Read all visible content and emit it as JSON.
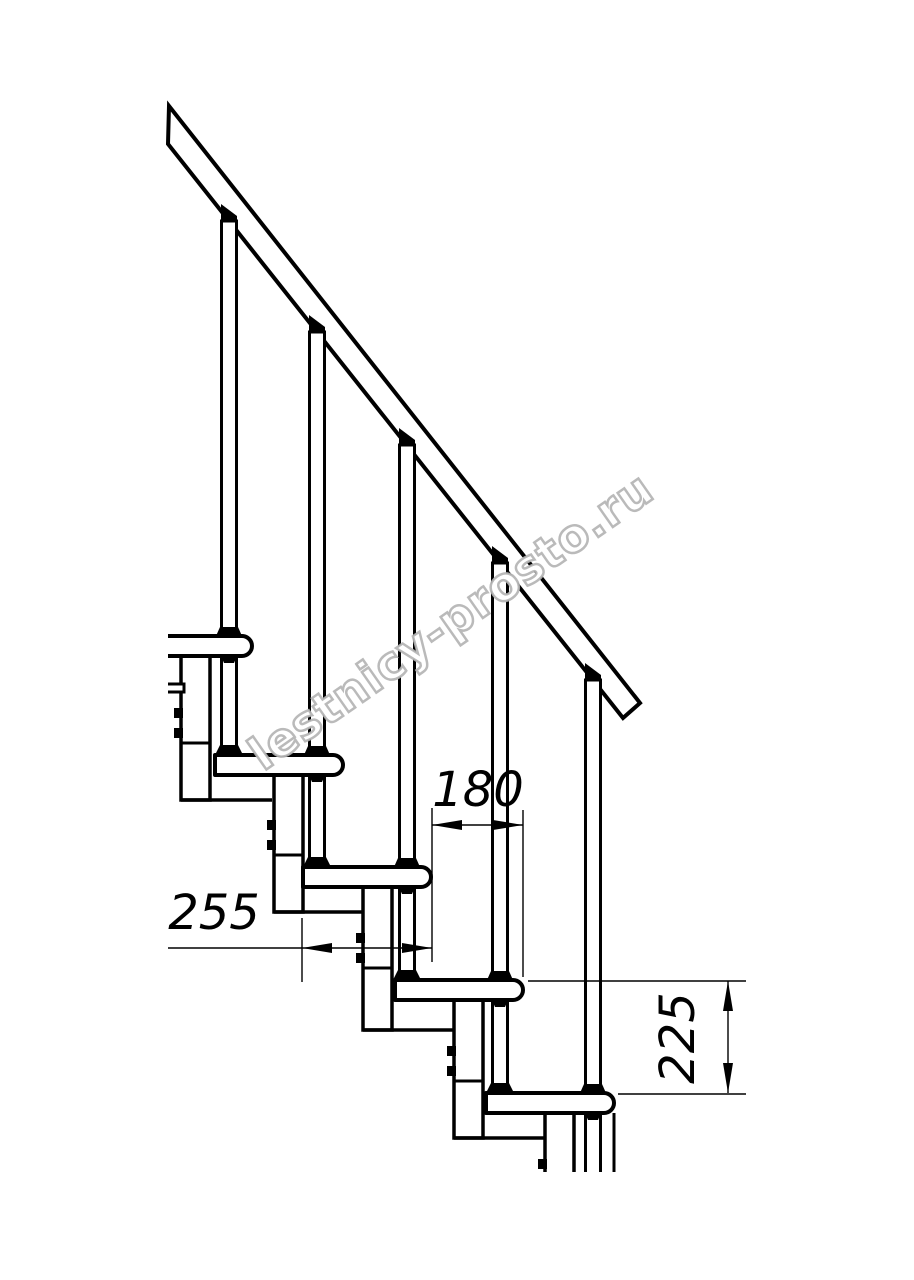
{
  "page": {
    "background": "#ffffff"
  },
  "drawing": {
    "width": 914,
    "height": 1280,
    "line_color": "#000000",
    "dimension_label_font_size": 48,
    "cut_bottom_y": 1172,
    "watermark": {
      "text": "lestnicy-prosto.ru",
      "outline_color": "#b3b3b3",
      "fill_color": "#ffffff",
      "x": 460,
      "y": 634,
      "rotation_deg": -35,
      "font_size": 46,
      "letter_spacing": 1
    },
    "handrail": {
      "outline": [
        [
          169,
          106
        ],
        [
          640,
          703
        ],
        [
          623,
          718
        ],
        [
          168,
          144
        ]
      ]
    },
    "tread_height": 20,
    "tread_corner_radius": 10,
    "treads": [
      {
        "left": 168,
        "front": 252,
        "top": 636,
        "cut_left": true
      },
      {
        "left": 215,
        "front": 343,
        "top": 755,
        "cut_left": false
      },
      {
        "left": 303,
        "front": 431,
        "top": 867,
        "cut_left": false
      },
      {
        "left": 395,
        "front": 523,
        "top": 980,
        "cut_left": false
      },
      {
        "left": 486,
        "front": 614,
        "top": 1093,
        "cut_left": false
      }
    ],
    "box_width": 29,
    "base_reach": 91,
    "support_boxes": [
      {
        "x": 181,
        "top": 656,
        "bottom": 800,
        "divider": 743,
        "bolts": [
          708,
          728
        ],
        "cut": false
      },
      {
        "x": 274,
        "top": 775,
        "bottom": 912,
        "divider": 855,
        "bolts": [
          820,
          840
        ],
        "cut": false
      },
      {
        "x": 363,
        "top": 887,
        "bottom": 1030,
        "divider": 968,
        "bolts": [
          933,
          953
        ],
        "cut": false
      },
      {
        "x": 454,
        "top": 1000,
        "bottom": 1138,
        "divider": 1081,
        "bolts": [
          1046,
          1066
        ],
        "cut": false
      },
      {
        "x": 545,
        "top": 1113,
        "bottom": 1172,
        "divider": null,
        "bolts": [
          1159
        ],
        "cut": true
      }
    ],
    "baluster_width": 15,
    "balusters": [
      {
        "cx": 229,
        "rail_y": 221,
        "tread_top": 636,
        "next_tread_top": 755
      },
      {
        "cx": 317,
        "rail_y": 332,
        "tread_top": 755,
        "next_tread_top": 867
      },
      {
        "cx": 407,
        "rail_y": 445,
        "tread_top": 867,
        "next_tread_top": 980
      },
      {
        "cx": 500,
        "rail_y": 563,
        "tread_top": 980,
        "next_tread_top": 1093
      },
      {
        "cx": 593,
        "rail_y": 680,
        "tread_top": 1093,
        "next_tread_top": null
      }
    ],
    "rear_tab": {
      "x1": 168,
      "x2": 184,
      "y1": 684,
      "y2": 692
    },
    "extra_lines": [
      {
        "x1": 614,
        "y1": 1113,
        "x2": 614,
        "y2": 1172
      }
    ],
    "dimensions": [
      {
        "label": "180",
        "value_mm": 180,
        "type": "horizontal",
        "y": 825,
        "x1": 432,
        "x2": 523,
        "tail_x": null,
        "extensions": [
          {
            "kind": "v",
            "x": 432,
            "y1": 808,
            "y2": 962
          },
          {
            "kind": "v",
            "x": 523,
            "y1": 810,
            "y2": 977
          }
        ],
        "label_x": 478,
        "label_y": 806,
        "label_rotation": 0
      },
      {
        "label": "255",
        "value_mm": 255,
        "type": "horizontal",
        "y": 948,
        "x1": 302,
        "x2": 432,
        "tail_x": 168,
        "extensions": [
          {
            "kind": "v",
            "x": 302,
            "y1": 918,
            "y2": 982
          }
        ],
        "label_x": 214,
        "label_y": 929,
        "label_rotation": 0
      },
      {
        "label": "225",
        "value_mm": 225,
        "type": "vertical",
        "x": 728,
        "y1": 981,
        "y2": 1093,
        "extensions": [
          {
            "kind": "h",
            "y": 981,
            "x1": 528,
            "x2": 746
          },
          {
            "kind": "h",
            "y": 1094,
            "x1": 618,
            "x2": 746
          }
        ],
        "label_x": 694,
        "label_y": 1038,
        "label_rotation": -90
      }
    ]
  }
}
